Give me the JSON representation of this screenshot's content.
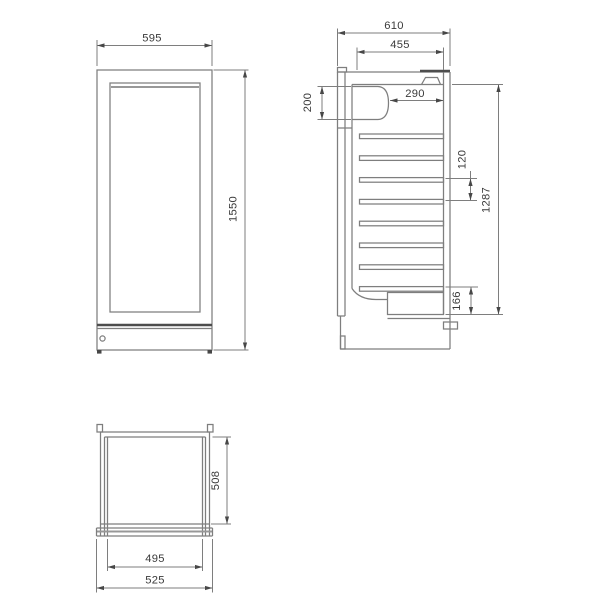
{
  "drawing": {
    "type": "technical-three-view",
    "subject": "refrigerated display cabinet",
    "colors": {
      "background": "#ffffff",
      "line": "#7e7e7e",
      "dark_line": "#4d4d4d",
      "text": "#3a3a3a"
    },
    "dimensions": {
      "front": {
        "width": "595",
        "height": "1550"
      },
      "side": {
        "overall_depth": "610",
        "interior_depth": "455",
        "top_section_height": "200",
        "upper_clear_depth": "290",
        "shelf_spacing": "120",
        "interior_height": "1287",
        "base_section_height": "166"
      },
      "plan": {
        "body_depth": "508",
        "inner_width": "495",
        "overall_width": "525"
      }
    }
  }
}
